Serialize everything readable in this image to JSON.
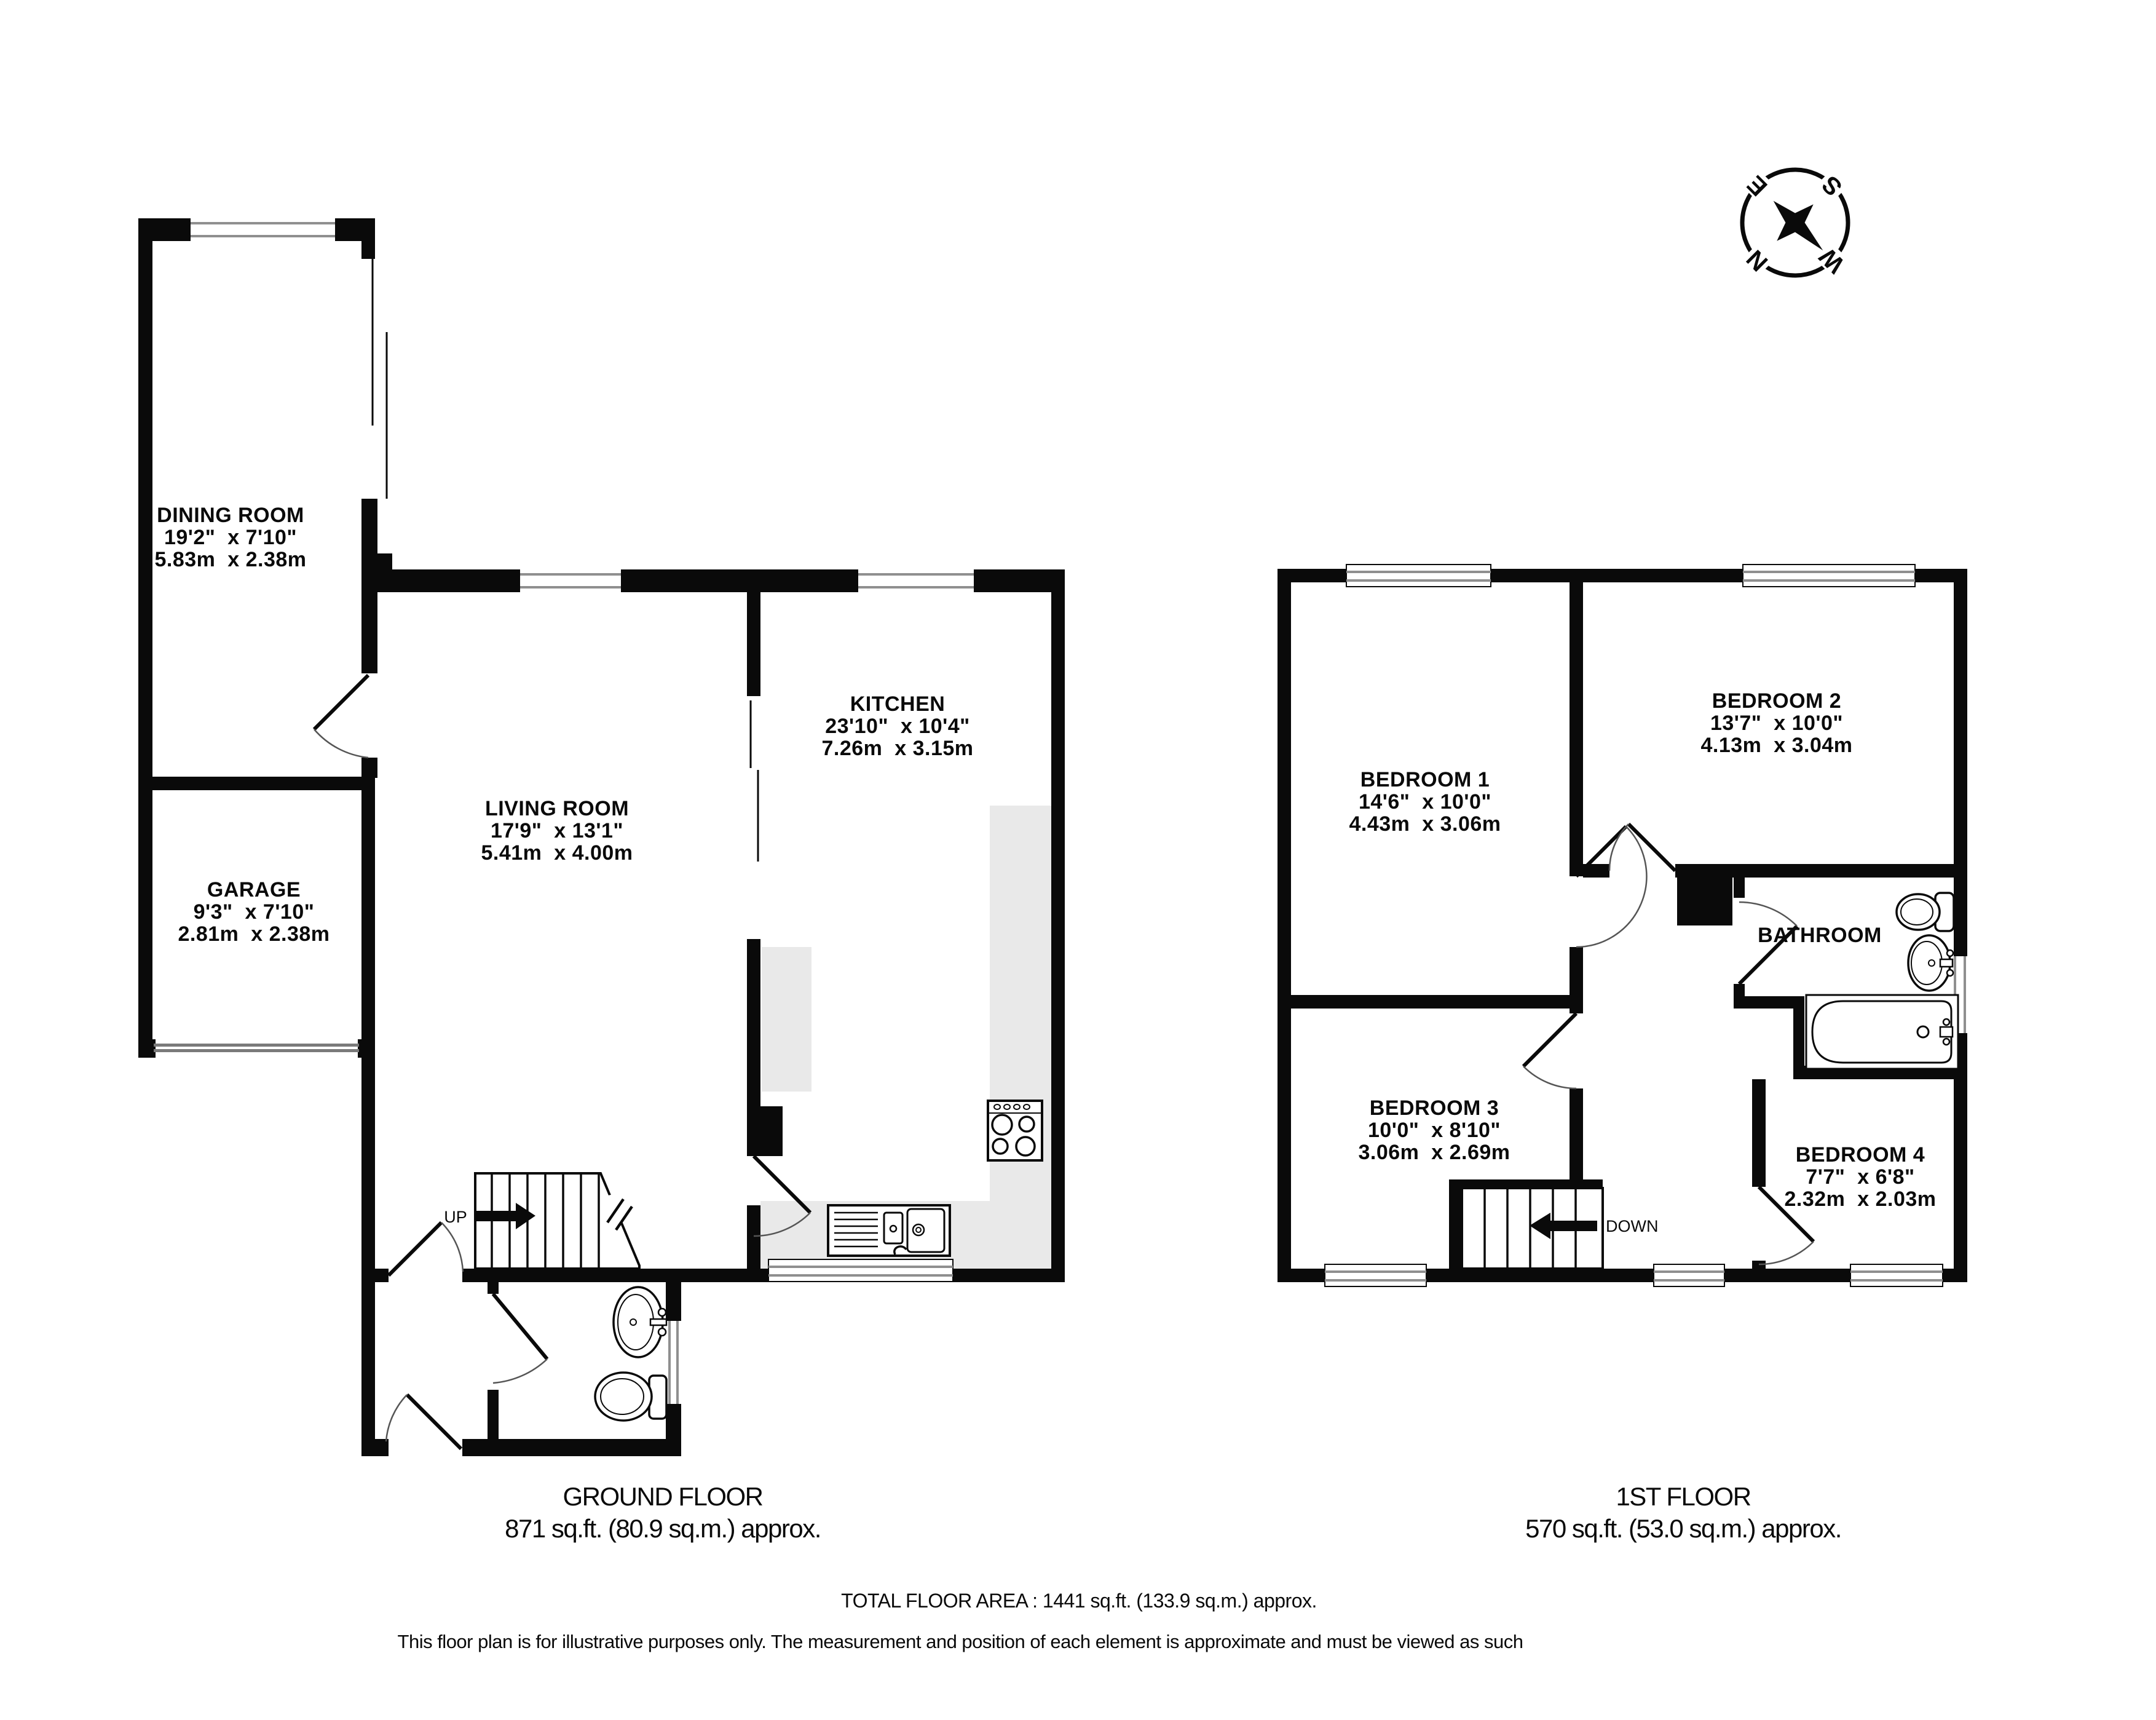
{
  "compass": {
    "north": "N",
    "east": "E",
    "south": "S",
    "west": "W"
  },
  "ground_floor": {
    "caption": {
      "title": "GROUND FLOOR",
      "area": "871 sq.ft. (80.9 sq.m.) approx."
    },
    "stairs": {
      "label": "UP"
    },
    "rooms": {
      "dining": {
        "name": "DINING ROOM",
        "imperial": "19'2\"  x 7'10\"",
        "metric": "5.83m  x 2.38m"
      },
      "garage": {
        "name": "GARAGE",
        "imperial": "9'3\"  x 7'10\"",
        "metric": "2.81m  x 2.38m"
      },
      "living": {
        "name": "LIVING ROOM",
        "imperial": "17'9\"  x 13'1\"",
        "metric": "5.41m  x 4.00m"
      },
      "kitchen": {
        "name": "KITCHEN",
        "imperial": "23'10\"  x 10'4\"",
        "metric": "7.26m  x 3.15m"
      }
    }
  },
  "first_floor": {
    "caption": {
      "title": "1ST FLOOR",
      "area": "570 sq.ft. (53.0 sq.m.) approx."
    },
    "stairs": {
      "label": "DOWN"
    },
    "rooms": {
      "bedroom1": {
        "name": "BEDROOM 1",
        "imperial": "14'6\"  x 10'0\"",
        "metric": "4.43m  x 3.06m"
      },
      "bedroom2": {
        "name": "BEDROOM 2",
        "imperial": "13'7\"  x 10'0\"",
        "metric": "4.13m  x 3.04m"
      },
      "bedroom3": {
        "name": "BEDROOM 3",
        "imperial": "10'0\"  x 8'10\"",
        "metric": "3.06m  x 2.69m"
      },
      "bedroom4": {
        "name": "BEDROOM 4",
        "imperial": "7'7\"  x 6'8\"",
        "metric": "2.32m  x 2.03m"
      },
      "bathroom": {
        "name": "BATHROOM"
      }
    }
  },
  "footer": {
    "total_area": "TOTAL FLOOR AREA : 1441 sq.ft. (133.9 sq.m.) approx.",
    "disclaimer": "This floor plan is for illustrative purposes only. The measurement and position of each element is approximate and must be viewed as such"
  }
}
